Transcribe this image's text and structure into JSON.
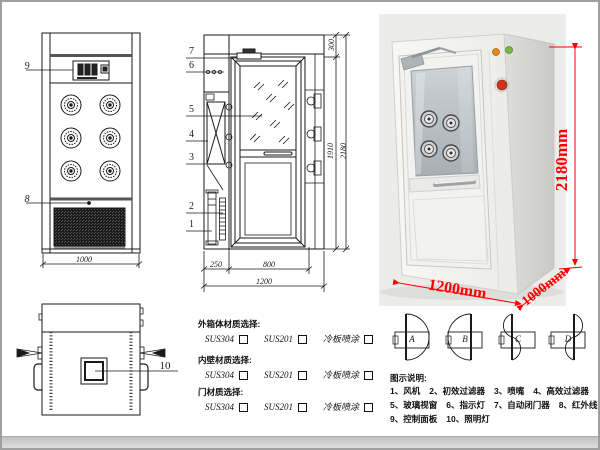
{
  "drawing": {
    "front_view": {
      "label_9": "9",
      "label_8": "8",
      "dim_width": "1000"
    },
    "section_view": {
      "label_7": "7",
      "label_6": "6",
      "label_5": "5",
      "label_4": "4",
      "label_3": "3",
      "label_2": "2",
      "label_1": "1",
      "dim_top": "300",
      "dim_inner_height": "1910",
      "dim_total_height": "2180",
      "dim_fan_depth": "250",
      "dim_door_width": "800",
      "dim_total_width": "1200"
    },
    "plan_view": {
      "label_10": "10"
    }
  },
  "photo": {
    "dim_height": "2180mm",
    "dim_width": "1200mm",
    "dim_depth": "1000mm",
    "dim_color": "#ff0000",
    "indicator_orange": "#e08a1e",
    "indicator_green": "#7ab648",
    "button_red": "#cc3322"
  },
  "door_configs": {
    "labels": [
      "A",
      "B",
      "C",
      "D"
    ]
  },
  "materials": {
    "sections": [
      {
        "title": "外箱体材质选择:",
        "options": [
          "SUS304",
          "SUS201",
          "冷板喷涂"
        ]
      },
      {
        "title": "内壁材质选择:",
        "options": [
          "SUS304",
          "SUS201",
          "冷板喷涂"
        ]
      },
      {
        "title": "门材质选择:",
        "options": [
          "SUS304",
          "SUS201",
          "冷板喷涂"
        ]
      }
    ]
  },
  "legend": {
    "title": "图示说明:",
    "rows": [
      [
        "1、风机",
        "2、初效过滤器",
        "3、喷嘴",
        "4、高效过滤器"
      ],
      [
        "5、玻璃视窗",
        "6、指示灯",
        "7、自动闭门器",
        "8、红外线感应器"
      ],
      [
        "9、控制面板",
        "10、照明灯"
      ]
    ]
  }
}
